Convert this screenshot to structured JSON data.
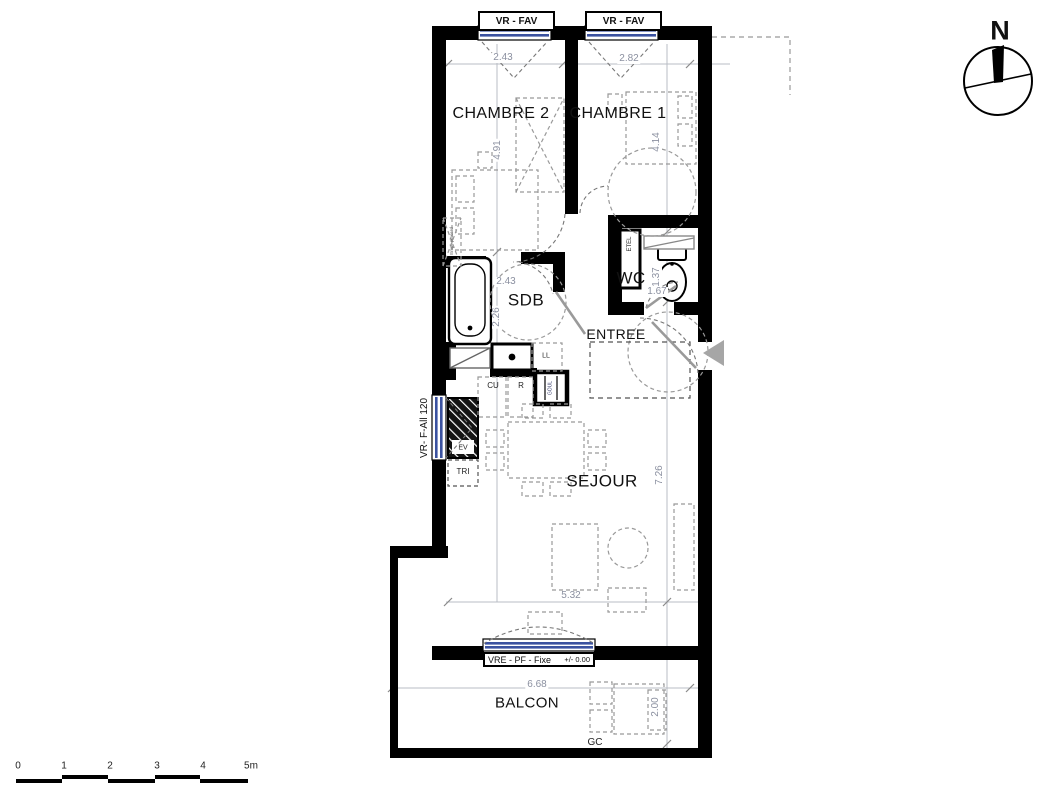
{
  "north": {
    "label": "N"
  },
  "rooms": {
    "chambre2": "CHAMBRE 2",
    "chambre1": "CHAMBRE 1",
    "sdb": "SDB",
    "wc": "WC",
    "entree": "ENTREE",
    "sejour": "SEJOUR",
    "balcon": "BALCON"
  },
  "windows": {
    "fav1": "VR - FAV",
    "fav2": "VR - FAV",
    "kitchen": "VR- F-All 120",
    "living_label": "VRE - PF - Fixe",
    "living_level": "+/- 0.00"
  },
  "fixtures": {
    "tri": "TRI",
    "ev": "EV",
    "cu": "CU",
    "r": "R",
    "ll": "LL",
    "etel": "ETEL",
    "goul": "GOUL",
    "placard": "Empl. placard",
    "gc": "GC"
  },
  "dims": {
    "win_ch2": "2.43",
    "win_ch1": "2.82",
    "ch2_height": "4.91",
    "ch1_height": "4.14",
    "sdb_width": "2.43",
    "sdb_height": "2.26",
    "wc_height": "1.37",
    "wc_width": "1.67",
    "sejour_height": "7.26",
    "sejour_width": "5.32",
    "balcon_width": "6.68",
    "balcon_depth": "2.00"
  },
  "scale_bar": {
    "ticks": [
      "0",
      "1",
      "2",
      "3",
      "4",
      "5m"
    ]
  },
  "colors": {
    "wall": "#000000",
    "glazing": "#3b52a0",
    "dim_text": "#8b90a0",
    "dash": "#999999"
  }
}
